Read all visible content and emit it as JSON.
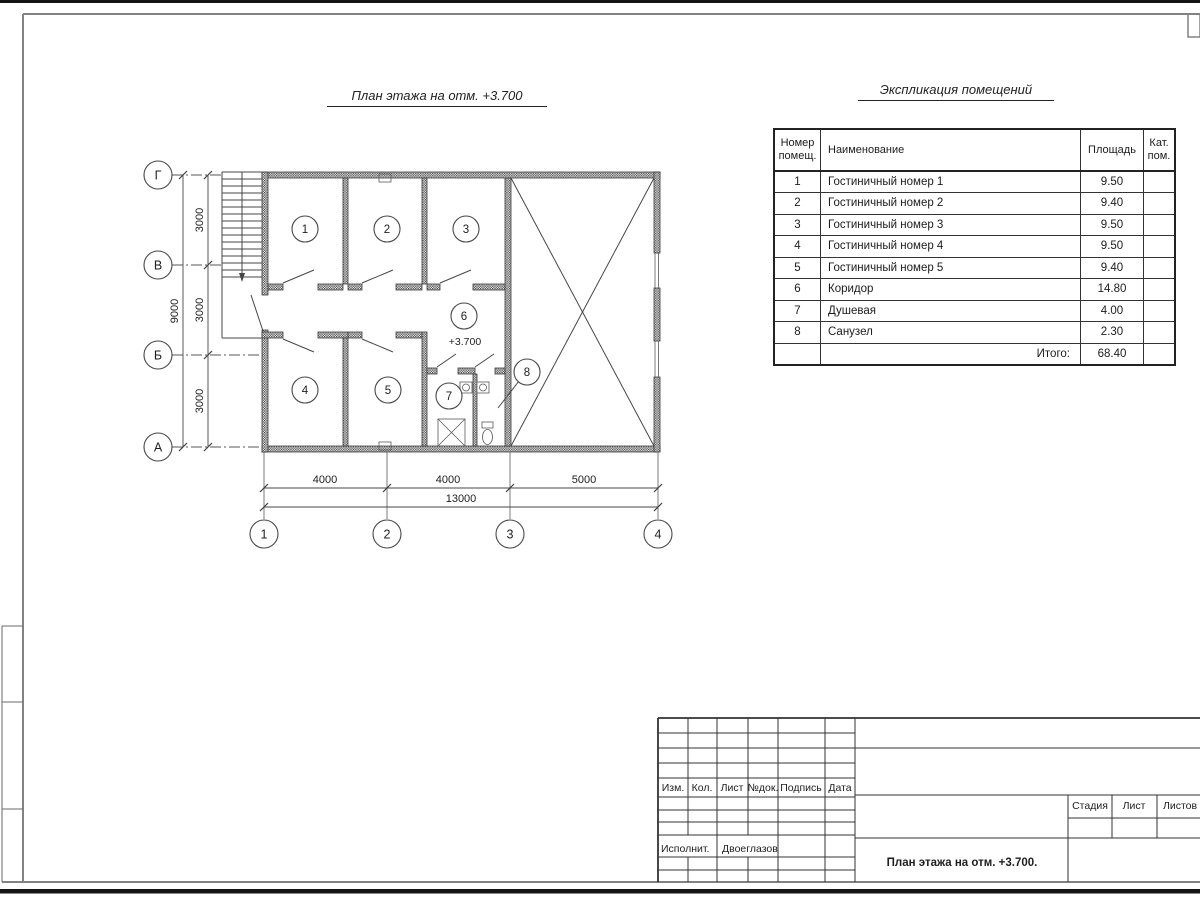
{
  "sheet": {
    "plan_title": "План этажа на отм. +3.700",
    "colors": {
      "background": "#ffffff",
      "linework": "#474747",
      "frame": "#828282",
      "text": "#1e1e1e",
      "edge_strip": "#141414"
    }
  },
  "plan": {
    "level_mark": "+3.700",
    "room_labels": [
      "1",
      "2",
      "3",
      "4",
      "5",
      "6",
      "7",
      "8"
    ],
    "axis_rows": [
      "Г",
      "В",
      "Б",
      "А"
    ],
    "axis_cols": [
      "1",
      "2",
      "3",
      "4"
    ],
    "dim_v": [
      "3000",
      "3000",
      "3000"
    ],
    "dim_v_total": "9000",
    "dim_h": [
      "4000",
      "4000",
      "5000"
    ],
    "dim_h_total": "13000"
  },
  "explication": {
    "title": "Экспликация помещений",
    "headers": {
      "number": "Номер\nпомещ.",
      "name": "Наименование",
      "area": "Площадь",
      "cat": "Кат.\nпом."
    },
    "rows": [
      {
        "number": "1",
        "name": "Гостиничный номер 1",
        "area": "9.50",
        "cat": ""
      },
      {
        "number": "2",
        "name": "Гостиничный номер 2",
        "area": "9.40",
        "cat": ""
      },
      {
        "number": "3",
        "name": "Гостиничный номер 3",
        "area": "9.50",
        "cat": ""
      },
      {
        "number": "4",
        "name": "Гостиничный номер 4",
        "area": "9.50",
        "cat": ""
      },
      {
        "number": "5",
        "name": "Гостиничный номер 5",
        "area": "9.40",
        "cat": ""
      },
      {
        "number": "6",
        "name": "Коридор",
        "area": "14.80",
        "cat": ""
      },
      {
        "number": "7",
        "name": "Душевая",
        "area": "4.00",
        "cat": ""
      },
      {
        "number": "8",
        "name": "Санузел",
        "area": "2.30",
        "cat": ""
      }
    ],
    "total_label": "Итого:",
    "total_area": "68.40"
  },
  "title_block": {
    "cols": [
      "Изм.",
      "Кол.",
      "Лист",
      "№док.",
      "Подпись",
      "Дата"
    ],
    "executor_label": "Исполнит.",
    "executor_name": "Двоеглазов",
    "stage_label": "Стадия",
    "sheet_label": "Лист",
    "sheets_label": "Листов",
    "doc_title": "План этажа на отм. +3.700."
  }
}
